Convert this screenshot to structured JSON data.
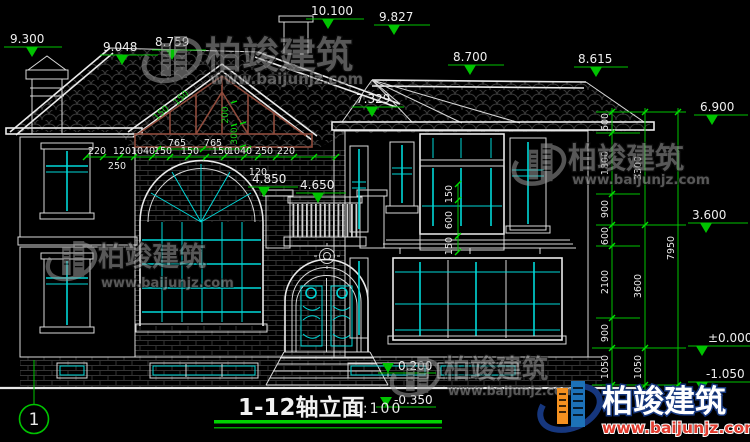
{
  "meta": {
    "drawing_title": "1-12轴立面",
    "scale": "1:100",
    "axis_label": "1"
  },
  "brand": {
    "name": "柏竣建筑",
    "site": "www.baijunjz.com"
  },
  "levels": {
    "m9300": "9.300",
    "m9048": "9.048",
    "m8759": "8.759",
    "m10100": "10.100",
    "m9827": "9.827",
    "m8700": "8.700",
    "m8615": "8.615",
    "m7329": "7.329",
    "m6900": "6.900",
    "m4850": "4.850",
    "m4650": "4.650",
    "m3600": "3.600",
    "mzero": "±0.000",
    "mneg1050": "-1.050",
    "m0200": "0.200",
    "mneg0350": "-0.350"
  },
  "dims": {
    "top_above": [
      "765",
      "765"
    ],
    "top": [
      "220",
      "120",
      "1040",
      "150",
      "150",
      "150",
      "1040",
      "250",
      "220"
    ],
    "top_below": [
      "250",
      "120"
    ],
    "truss": [
      "150",
      "150",
      "200",
      "300"
    ],
    "bay": [
      "150",
      "600",
      "150"
    ],
    "right_inner": [
      "600",
      "1800",
      "900",
      "600",
      "2100",
      "900",
      "1050"
    ],
    "right_mid": [
      "3300",
      "3600",
      "1050"
    ],
    "right_outer": "7950"
  },
  "colors": {
    "dim_green": "#00c300",
    "glazing_cyan": "#00d8d8",
    "truss_brown": "#8f4b3c",
    "logo_orange": "#f59120",
    "logo_blue": "#1d72b8",
    "site_red": "#e23b2e",
    "line_white": "#d9d9d9",
    "background": "#000000"
  }
}
